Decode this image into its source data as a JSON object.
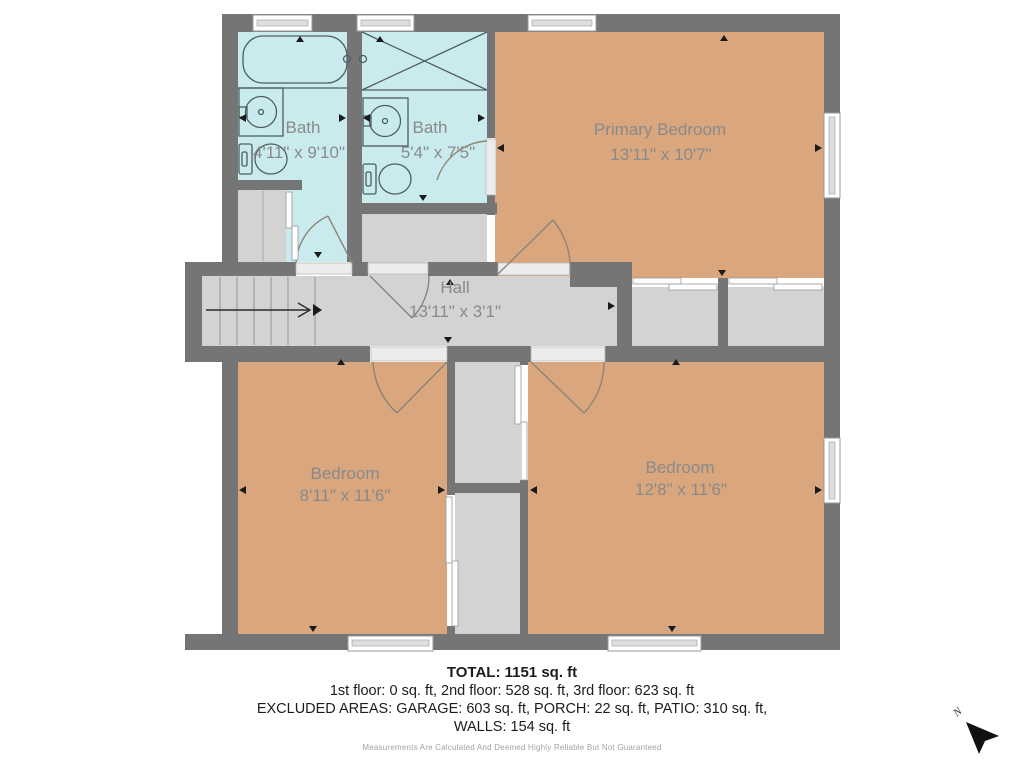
{
  "rooms": {
    "bath1": {
      "name": "Bath",
      "dims": "4'11\" x 9'10\""
    },
    "bath2": {
      "name": "Bath",
      "dims": "5'4\" x 7'5\""
    },
    "primary": {
      "name": "Primary Bedroom",
      "dims": "13'11\" x 10'7\""
    },
    "hall": {
      "name": "Hall",
      "dims": "13'11\" x 3'1\""
    },
    "bedroom_left": {
      "name": "Bedroom",
      "dims": "8'11\" x 11'6\""
    },
    "bedroom_right": {
      "name": "Bedroom",
      "dims": "12'8\" x 11'6\""
    }
  },
  "compass": {
    "north_label": "N"
  },
  "footer": {
    "total": "TOTAL: 1151 sq. ft",
    "floors": "1st floor: 0 sq. ft, 2nd floor: 528 sq. ft, 3rd floor: 623 sq. ft",
    "excluded": "EXCLUDED AREAS: GARAGE: 603 sq. ft, PORCH: 22 sq. ft, PATIO: 310 sq. ft,",
    "walls": "WALLS: 154 sq. ft",
    "disclaimer": "Measurements Are Calculated And Deemed Highly Reliable But Not Guaranteed"
  },
  "colors": {
    "wall": "#757575",
    "bedroom_floor": "#d9a67d",
    "bath_floor": "#c9ebee",
    "hall_floor": "#d3d3d3",
    "label_text": "#8a8a8a"
  }
}
